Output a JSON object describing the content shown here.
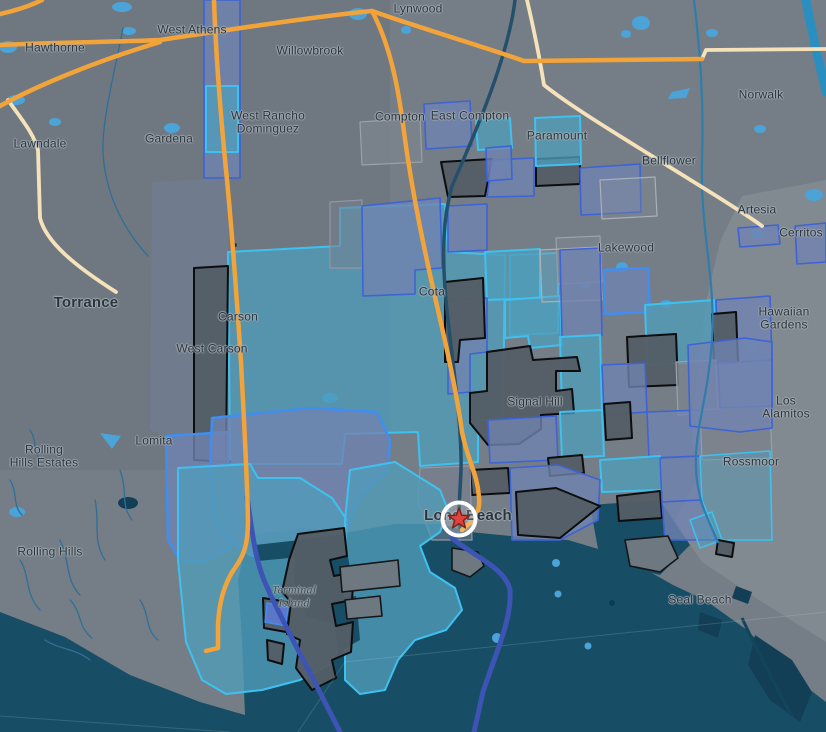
{
  "map": {
    "description": "Dark-themed road map of the South Bay / Long Beach area with a census-tract style overlay and a starred location",
    "palette": {
      "base": "#757e86",
      "water": "#174e66",
      "pond": "#4ba3d8",
      "teal_fill": "#4f9cba",
      "blue_fill": "#7083b0",
      "dark_fill": "#545e66",
      "cyan_line": "#3fc1f0",
      "indigo_line": "#3d63d6",
      "bright_blue_line": "#3f8ef0",
      "hwy_orange": "#f2a43a",
      "hwy_cream": "#f6e2ba",
      "route_indigo": "#3d54b4",
      "label": "#2b333b",
      "star_red": "#e0433c",
      "ring_white": "#ffffff"
    },
    "marker": {
      "kind": "starred place",
      "x": 459,
      "y": 519
    },
    "labels": [
      {
        "text": "Lynwood",
        "x": 418,
        "y": 9
      },
      {
        "text": "Hawthorne",
        "x": 55,
        "y": 48
      },
      {
        "text": "West Athens",
        "x": 192,
        "y": 30
      },
      {
        "text": "Willowbrook",
        "x": 310,
        "y": 51
      },
      {
        "text": "Lawndale",
        "x": 40,
        "y": 144
      },
      {
        "text": "Gardena",
        "x": 169,
        "y": 139
      },
      {
        "text": "West Rancho\nDominguez",
        "x": 268,
        "y": 122
      },
      {
        "text": "Compton",
        "x": 400,
        "y": 117
      },
      {
        "text": "East Compton",
        "x": 470,
        "y": 116
      },
      {
        "text": "Paramount",
        "x": 557,
        "y": 136
      },
      {
        "text": "Norwalk",
        "x": 761,
        "y": 95
      },
      {
        "text": "Bellflower",
        "x": 669,
        "y": 161
      },
      {
        "text": "Artesia",
        "x": 757,
        "y": 210
      },
      {
        "text": "Cerritos",
        "x": 801,
        "y": 233
      },
      {
        "text": "Lakewood",
        "x": 626,
        "y": 248
      },
      {
        "text": "Hawaiian\nGardens",
        "x": 784,
        "y": 318
      },
      {
        "text": "Torrance",
        "x": 86,
        "y": 303,
        "size": 15,
        "weight": 600
      },
      {
        "text": "Carson",
        "x": 238,
        "y": 317
      },
      {
        "text": "West Carson",
        "x": 212,
        "y": 349
      },
      {
        "text": "Cota",
        "x": 432,
        "y": 292
      },
      {
        "text": "Signal Hill",
        "x": 535,
        "y": 402
      },
      {
        "text": "Lomita",
        "x": 154,
        "y": 441
      },
      {
        "text": "Rolling\nHills Estates",
        "x": 44,
        "y": 456
      },
      {
        "text": "Los Alamitos",
        "x": 786,
        "y": 407
      },
      {
        "text": "Rossmoor",
        "x": 751,
        "y": 462
      },
      {
        "text": "Rolling Hills",
        "x": 50,
        "y": 552
      },
      {
        "text": "Long Beach",
        "x": 468,
        "y": 516,
        "size": 15,
        "weight": 600
      },
      {
        "text": "Terminal\nIsland",
        "x": 294,
        "y": 596,
        "italic": true,
        "color": "#3e4d58"
      },
      {
        "text": "Seal Beach",
        "x": 700,
        "y": 600
      }
    ]
  }
}
